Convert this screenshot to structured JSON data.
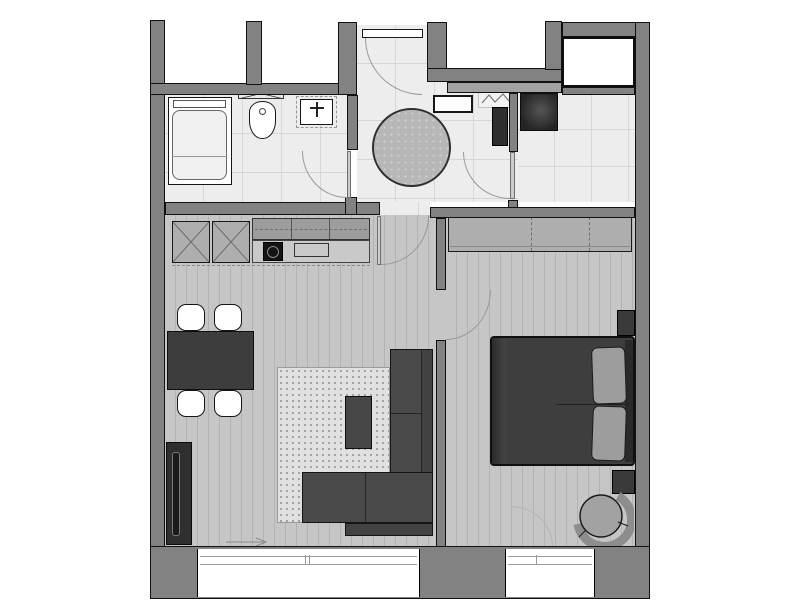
{
  "canvas": {
    "width": 800,
    "height": 600,
    "background": "#ffffff"
  },
  "colors": {
    "wall": "#828282",
    "wall_light": "#a2a2a2",
    "outline": "#111111",
    "tile": "#ededed",
    "tile_line": "#d7d7d7",
    "wood": "#c6c6c6",
    "wood_line": "#b3b3b3",
    "rug": "#e0e0e0",
    "rug_dot": "#8f8f8f",
    "round_rug": "#b7b7b7",
    "sofa": "#4a4a4a",
    "table": "#3d3d3d",
    "wardrobe": "#aeaeae",
    "pillow": "#9d9d9d",
    "appliance": "#2e2e2e",
    "arc": "#999999"
  },
  "plan": {
    "type": "one-bedroom-apartment-floor-plan",
    "rooms": [
      {
        "id": "bathroom",
        "floor": "tile",
        "items": [
          "bathtub",
          "toilet",
          "washbasin",
          "wall-radiator",
          "swing-door"
        ]
      },
      {
        "id": "entry-hall",
        "floor": "tile",
        "items": [
          "entrance-door",
          "round-rug",
          "wall-shelf",
          "electrical-panel"
        ]
      },
      {
        "id": "utility-area",
        "floor": "tile",
        "items": [
          "washing-machine",
          "tall-dark-cabinet",
          "swing-door"
        ]
      },
      {
        "id": "living-kitchen",
        "floor": "wood",
        "items": [
          "tall-kitchen-unit",
          "tall-kitchen-unit",
          "upper-cabinets",
          "counter",
          "cooktop",
          "kitchen-sink",
          "dining-table",
          "dining-chair",
          "dining-chair",
          "dining-chair",
          "dining-chair",
          "area-rug",
          "coffee-table",
          "corner-sofa",
          "tv-unit",
          "swing-door"
        ]
      },
      {
        "id": "bedroom",
        "floor": "wood",
        "items": [
          "wardrobe",
          "double-bed",
          "pillow",
          "pillow",
          "nightstand",
          "nightstand",
          "armchair",
          "swing-door"
        ]
      }
    ],
    "windows": [
      "living-room-window",
      "bedroom-window"
    ],
    "shaft": "duct-shaft",
    "door_count": 5
  }
}
